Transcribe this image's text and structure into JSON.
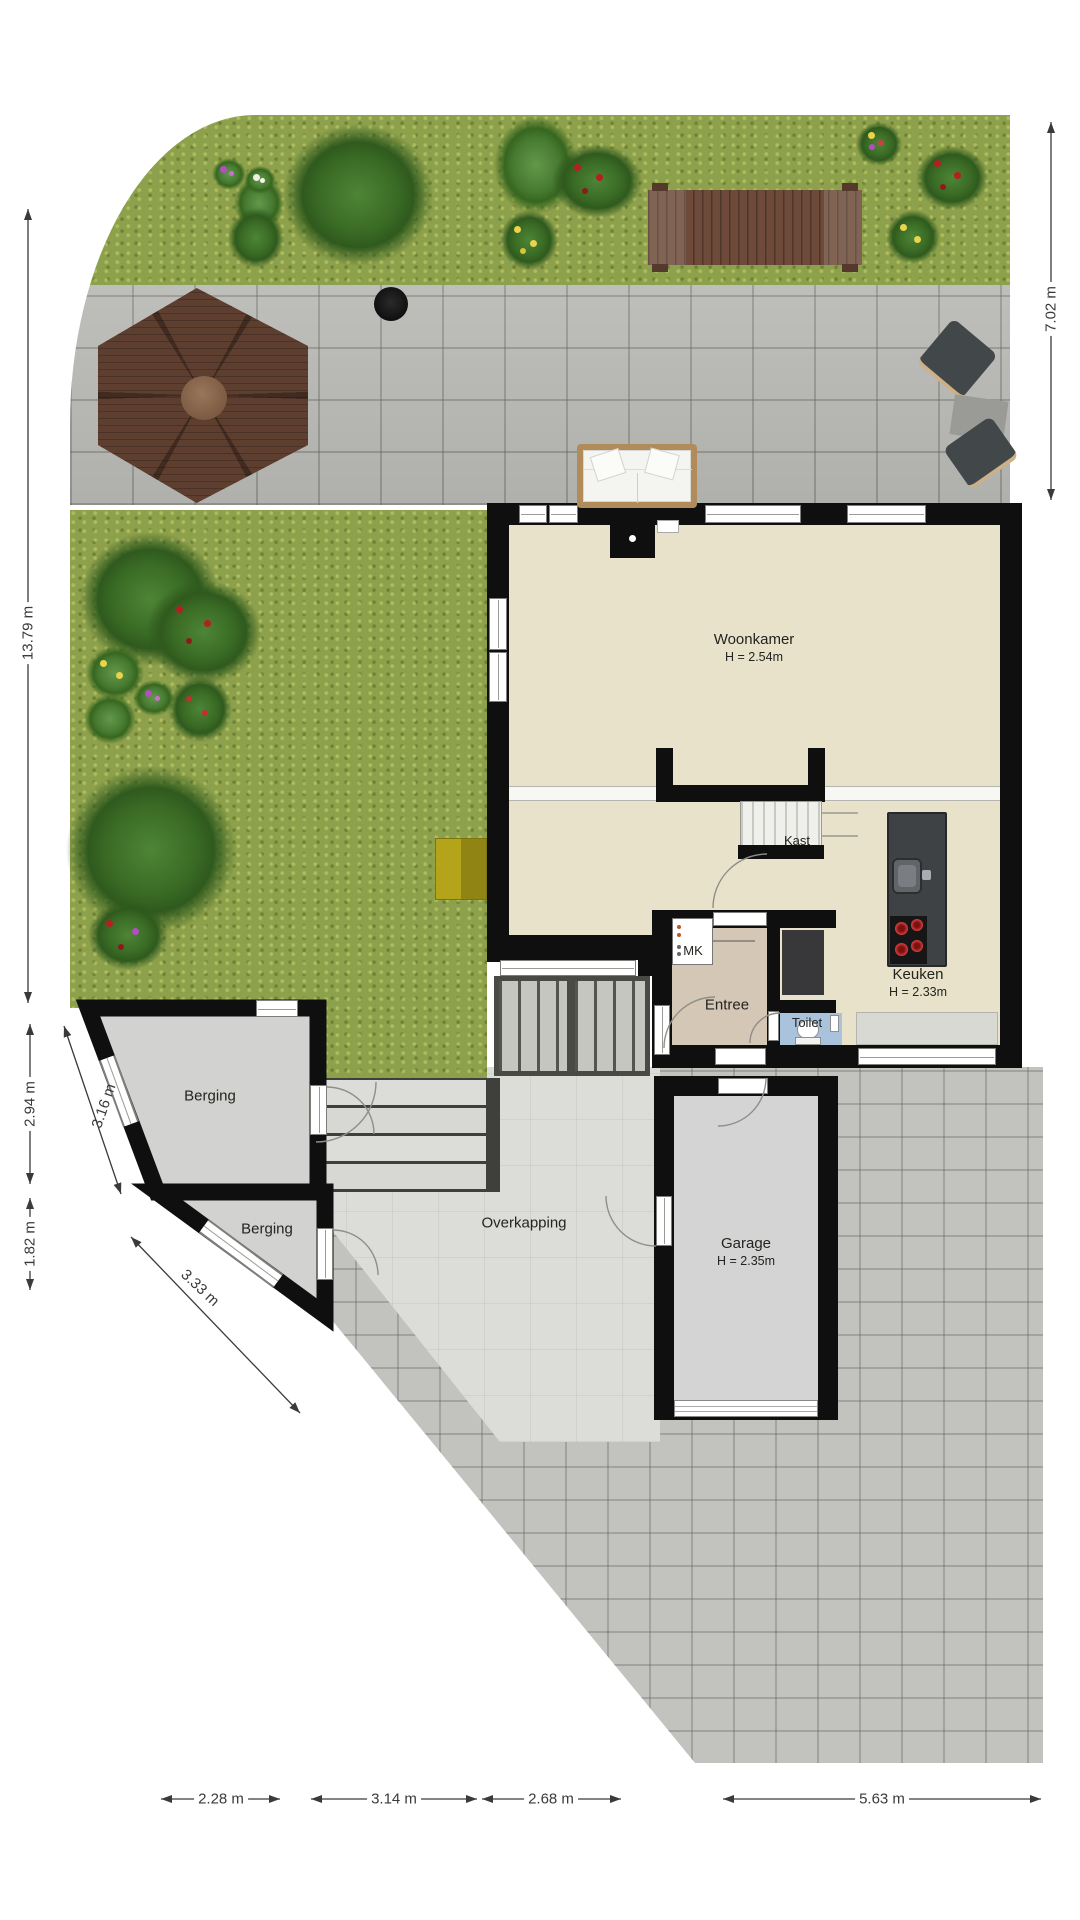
{
  "title": "Begane grond plattegrond met tuin",
  "rooms": {
    "woonkamer": {
      "name": "Woonkamer",
      "height": "H = 2.54m"
    },
    "keuken": {
      "name": "Keuken",
      "height": "H = 2.33m"
    },
    "garage": {
      "name": "Garage",
      "height": "H = 2.35m"
    },
    "entree": {
      "name": "Entree"
    },
    "toilet": {
      "name": "Toilet"
    },
    "kast": {
      "name": "Kast"
    },
    "mk": {
      "name": "MK"
    },
    "berging_upper": {
      "name": "Berging"
    },
    "berging_lower": {
      "name": "Berging"
    },
    "overkapping": {
      "name": "Overkapping"
    }
  },
  "dimensions": {
    "garden_right": "7.02 m",
    "garden_left": "13.79 m",
    "berging_left": "2.94 m",
    "berging_wall": "3.16 m",
    "berging_lower_left": "1.82 m",
    "berging_lower_wall": "3.33 m",
    "bottom": [
      "2.28 m",
      "3.14 m",
      "2.68 m",
      "5.63 m"
    ]
  },
  "colors": {
    "wall": "#0f0f0f",
    "living_floor": "#e9e2cb",
    "entree_floor": "#d5c7b5",
    "toilet_floor": "#a9c3dd",
    "garage_floor": "#d3d4d3",
    "berging_floor": "#d2d3d0",
    "grass": "#8da04b",
    "terrace_paving": "#b9bab5",
    "driveway_paving": "#c2c3bf",
    "overkapping_floor": "#dcddd9",
    "deck_wood": "#6d4a39",
    "gazebo_wood": "#5d3e2f",
    "dimension_text": "#3a3a3a"
  }
}
